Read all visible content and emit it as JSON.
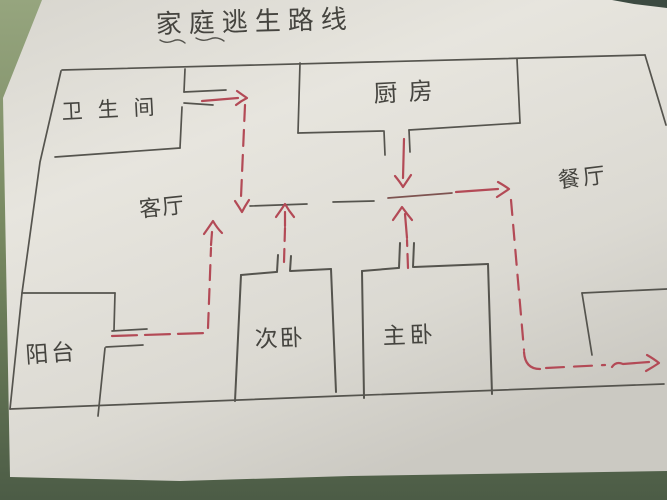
{
  "title": "家庭逃生路线",
  "rooms": {
    "bathroom": {
      "label": "卫生间"
    },
    "kitchen": {
      "label": "厨房"
    },
    "living_room": {
      "label": "客厅"
    },
    "dining_room": {
      "label": "餐厅"
    },
    "second_bedroom": {
      "label": "次卧"
    },
    "master_bedroom": {
      "label": "主卧"
    },
    "balcony": {
      "label": "阳台"
    }
  },
  "routes": [
    {
      "id": "bathroom-route",
      "from": "bathroom",
      "to": "living-room-hall"
    },
    {
      "id": "kitchen-route",
      "from": "kitchen",
      "to": "hall-junction"
    },
    {
      "id": "second-bedroom-route",
      "from": "second_bedroom",
      "to": "living-room-hall"
    },
    {
      "id": "master-bedroom-route",
      "from": "master_bedroom",
      "to": "hall-junction"
    },
    {
      "id": "balcony-route",
      "from": "balcony",
      "to": "living-room-hall"
    },
    {
      "id": "exit-route",
      "from": "hall-junction",
      "to": "front-door-exit"
    }
  ],
  "colors": {
    "route_ink": "#b34a56",
    "pencil": "#55544e",
    "label_ink": "#45443f",
    "paper": "#e2e0d9",
    "desk": "#7c8d68"
  }
}
